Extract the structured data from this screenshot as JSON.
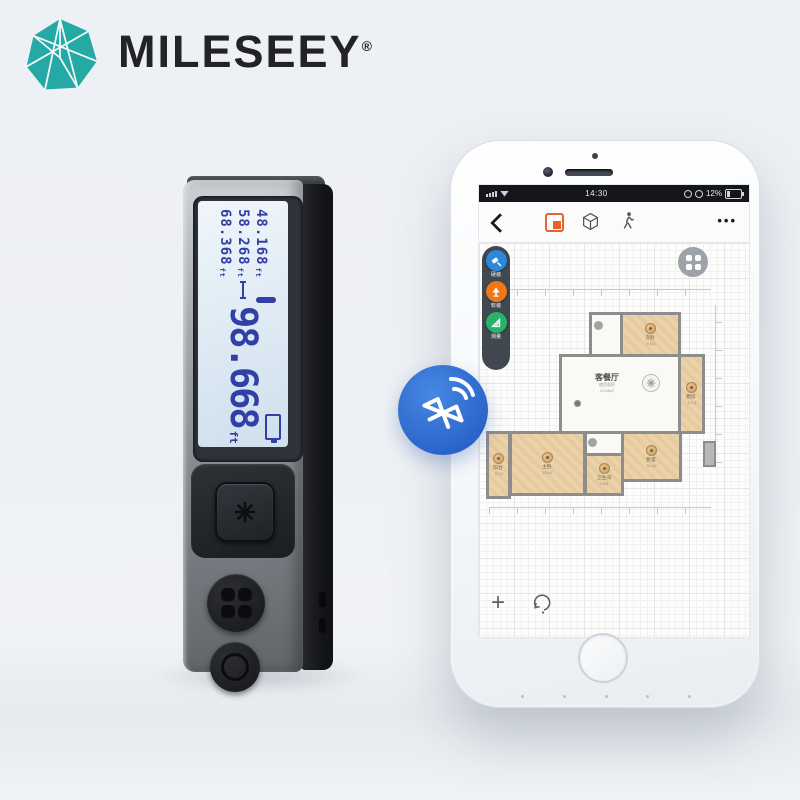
{
  "brand": {
    "name": "MILESEEY",
    "reg": "®"
  },
  "colors": {
    "brand_teal": "#25a9a4",
    "accent_orange": "#e8622d",
    "bluetooth_blue": "#2a63c8",
    "lcd_digit_blue": "#3040a6",
    "room_fill_tan": "#e8cda2",
    "wall_gray": "#8d8d8d"
  },
  "device": {
    "lcd": {
      "history": [
        {
          "value": "48.168",
          "unit": "ft"
        },
        {
          "value": "58.268",
          "unit": "ft"
        },
        {
          "value": "68.368",
          "unit": "ft"
        }
      ],
      "main": {
        "value": "98.668",
        "unit": "ft"
      }
    }
  },
  "phone": {
    "status_bar": {
      "time": "14:30",
      "battery_percent": "12%"
    },
    "toolbar": {
      "more": "•••"
    },
    "sidebar": {
      "items": [
        {
          "label": "硬装",
          "color": "#2e87d8"
        },
        {
          "label": "软装",
          "color": "#f07818"
        },
        {
          "label": "测量",
          "color": "#27b36a"
        }
      ]
    },
    "canvas": {
      "add_label": "+",
      "floorplan": {
        "living": {
          "name": "客餐厅",
          "area_line1": "使用面积",
          "area_line2": "23.66㎡"
        },
        "rooms": [
          {
            "name": "次卧",
            "area": "8.6㎡"
          },
          {
            "name": "厨房",
            "area": "5.2㎡"
          },
          {
            "name": "卧室",
            "area": "10.4㎡"
          },
          {
            "name": "卫生间",
            "area": "3.8㎡"
          },
          {
            "name": "主卧",
            "area": "12.9㎡"
          },
          {
            "name": "阳台",
            "area": "3.2㎡"
          }
        ]
      }
    }
  }
}
